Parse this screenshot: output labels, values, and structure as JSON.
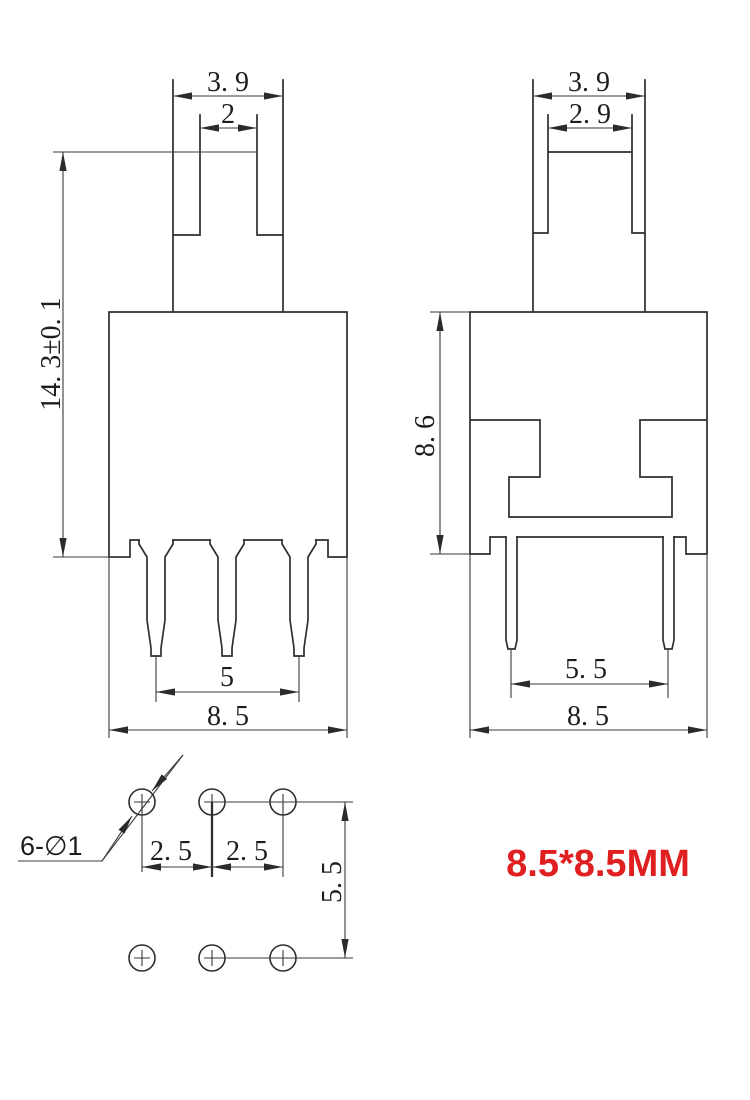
{
  "front_view": {
    "dim_cap_width": "3. 9",
    "dim_stem_width": "2",
    "dim_total_height": "14. 3±0. 1",
    "dim_pin_span": "5",
    "dim_body_width": "8. 5"
  },
  "side_view": {
    "dim_cap_width": "3. 9",
    "dim_stem_width": "2. 9",
    "dim_body_height": "8. 6",
    "dim_pin_span": "5. 5",
    "dim_body_width": "8. 5"
  },
  "bottom_view": {
    "hole_callout": "6-∅1",
    "dim_pitch_left": "2. 5",
    "dim_pitch_right": "2. 5",
    "dim_row_span": "5. 5"
  },
  "callout": {
    "size_text": "8.5*8.5MM",
    "color": "#e02020"
  }
}
